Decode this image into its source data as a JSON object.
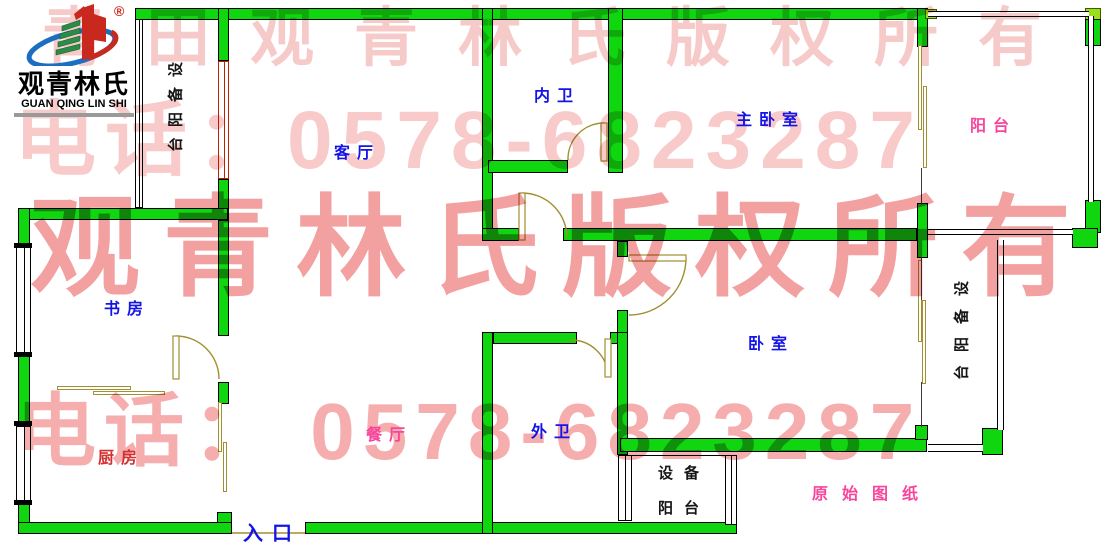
{
  "logo": {
    "name_cn": "观青林氏",
    "name_en": "GUAN QING LIN SHI",
    "registered_mark": "®"
  },
  "watermark": {
    "row1": "青田观青林氏版权所有",
    "row2": "电话：0578-6823287",
    "row3": "观青林氏版权所有",
    "row4": "电话： 0578-6823287",
    "phone": "0578-6823287"
  },
  "rooms": {
    "dev_balcony_top_left": "设备阳台",
    "living_room": "客厅",
    "inner_bath": "内卫",
    "master_bedroom": "主卧室",
    "balcony": "阳台",
    "study": "书房",
    "bedroom": "卧室",
    "dev_balcony_right": "设备阳台",
    "kitchen": "厨房",
    "dining_room": "餐厅",
    "outer_bath": "外卫",
    "dev_balcony_bottom_line1": "设备",
    "dev_balcony_bottom_line2": "阳台",
    "original_note": "原始图纸",
    "entrance": "入口"
  },
  "colors": {
    "wall_green": "#0fd60f",
    "wall_light_green": "#9ade1c",
    "label_blue": "#1414e6",
    "label_red": "#d43030",
    "label_pink": "#f8459c",
    "door_olive": "#a09030",
    "window_red_frame": "#c22000",
    "watermark_light_pink": "#f8caca",
    "watermark_dark_pink": "#f2a0a0"
  }
}
